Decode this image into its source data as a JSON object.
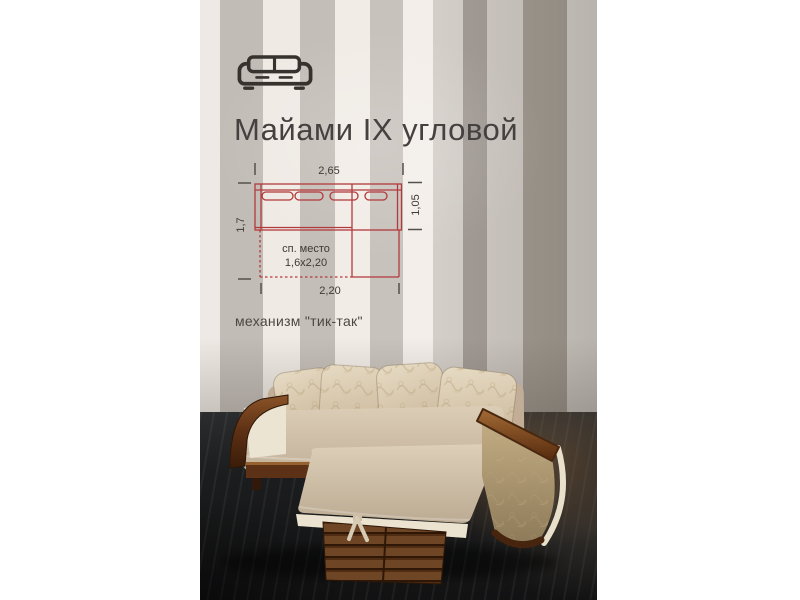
{
  "header": {
    "icon": "sofa-outline-icon",
    "title": "Майами IX угловой"
  },
  "diagram": {
    "dim_top": "2,65",
    "dim_bottom": "2,20",
    "dim_left": "1,7",
    "dim_right": "1,05",
    "sleeping_line1": "сп. место",
    "sleeping_line2": "1,6х2,20"
  },
  "mechanism": {
    "text": "механизм \"тик-так\""
  },
  "palette": {
    "diagram_lines": "#b23a3c",
    "diagram_text": "#3f3a36",
    "title_text": "#454140",
    "wallpaper_light": "#f1ece6",
    "wallpaper_gray": "#c4beb8",
    "wallpaper_taupe": "#a09990",
    "floor_dark": "#1b1c1d",
    "sofa_fabric": "#cfc0aa",
    "pillow_fabric": "#ddd0b8",
    "wood": "#5d3418",
    "cream_trim": "#ebe2cf"
  }
}
